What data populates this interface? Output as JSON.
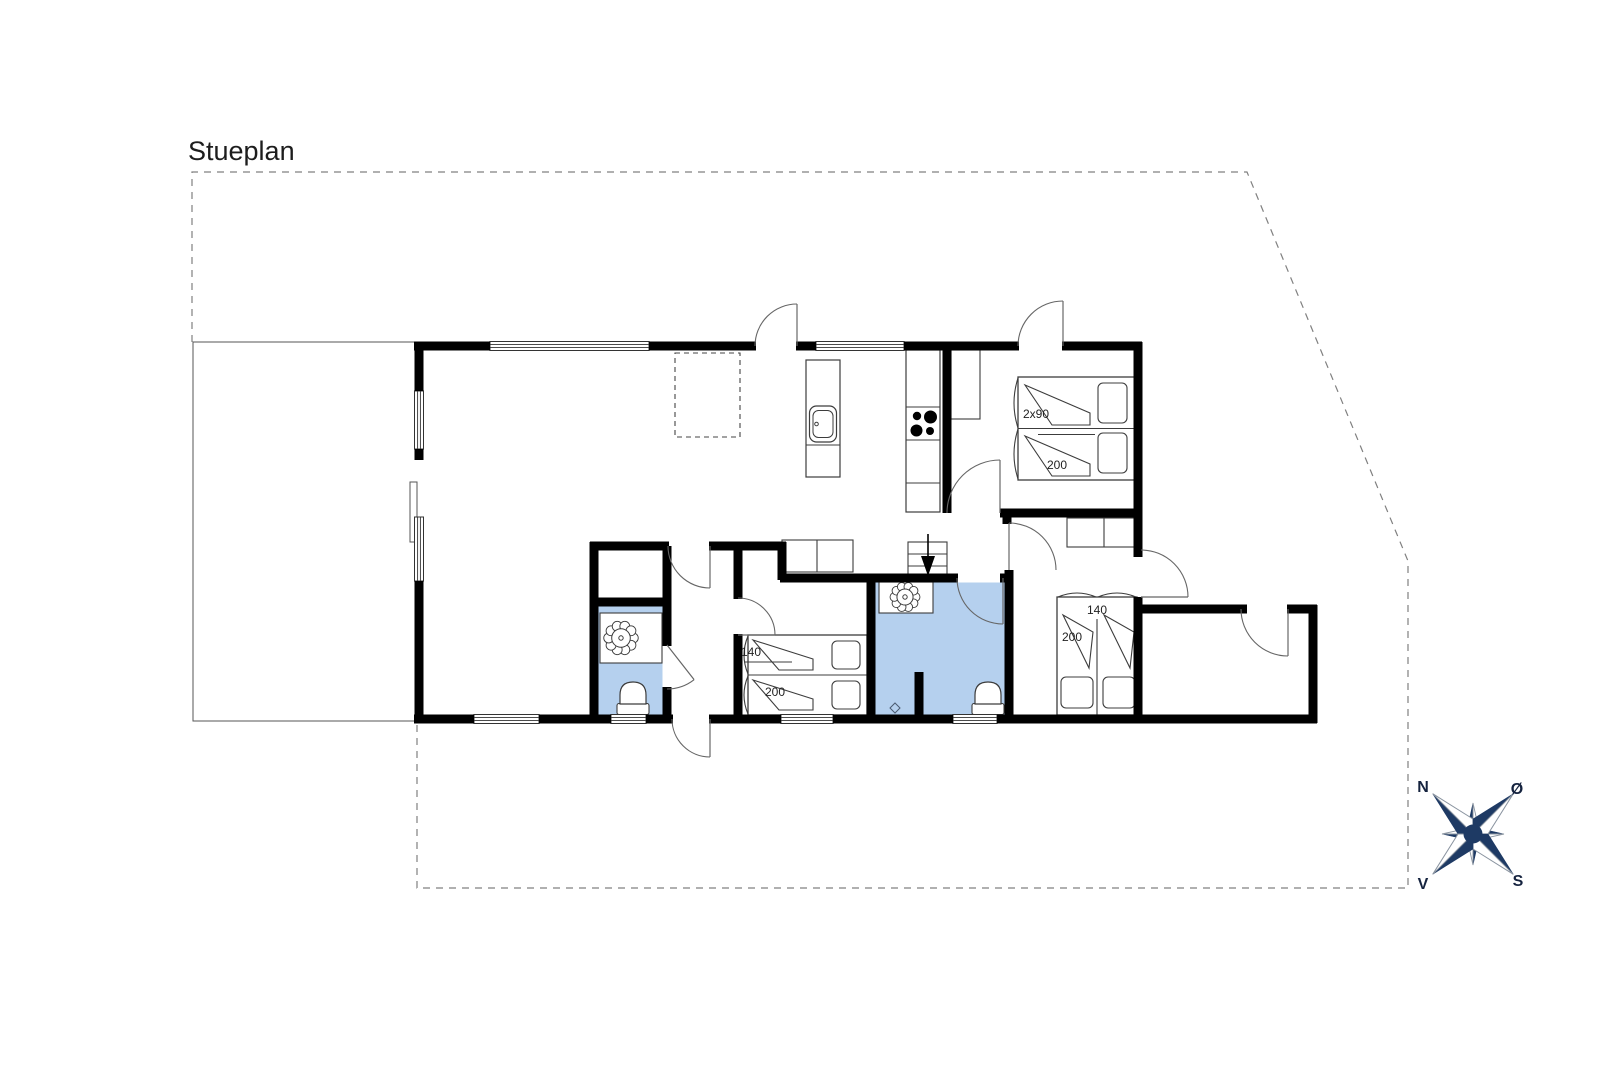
{
  "texts": [
    {
      "id": "plan-title",
      "t": "Stueplan",
      "x": 188,
      "y": 160,
      "s": 27,
      "a": "start",
      "fw": "400",
      "f": "#1d1d1d"
    },
    {
      "id": "bed1-width-label",
      "t": "2x90",
      "x": 1036,
      "y": 418,
      "s": 12,
      "a": "middle",
      "fw": "400",
      "f": "#222222"
    },
    {
      "id": "bed1-length-label",
      "t": "200",
      "x": 1057,
      "y": 469,
      "s": 12,
      "a": "middle",
      "fw": "400",
      "f": "#222222"
    },
    {
      "id": "bed2-width-label",
      "t": "140",
      "x": 751,
      "y": 656,
      "s": 12,
      "a": "middle",
      "fw": "400",
      "f": "#222222"
    },
    {
      "id": "bed2-length-label",
      "t": "200",
      "x": 775,
      "y": 696,
      "s": 12,
      "a": "middle",
      "fw": "400",
      "f": "#222222"
    },
    {
      "id": "bed3-width-label",
      "t": "140",
      "x": 1097,
      "y": 614,
      "s": 12,
      "a": "middle",
      "fw": "400",
      "f": "#222222"
    },
    {
      "id": "bed3-length-label",
      "t": "200",
      "x": 1072,
      "y": 641,
      "s": 12,
      "a": "middle",
      "fw": "400",
      "f": "#222222"
    },
    {
      "id": "compass-label-north",
      "t": "N",
      "x": 1423,
      "y": 792,
      "s": 16,
      "a": "middle",
      "fw": "600",
      "f": "#15233f"
    },
    {
      "id": "compass-label-east",
      "t": "Ø",
      "x": 1517,
      "y": 794,
      "s": 16,
      "a": "middle",
      "fw": "600",
      "f": "#15233f"
    },
    {
      "id": "compass-label-south",
      "t": "S",
      "x": 1518,
      "y": 886,
      "s": 16,
      "a": "middle",
      "fw": "600",
      "f": "#15233f"
    },
    {
      "id": "compass-label-west",
      "t": "V",
      "x": 1423,
      "y": 889,
      "s": 16,
      "a": "middle",
      "fw": "600",
      "f": "#15233f"
    }
  ],
  "colors": {
    "wall": "#000000",
    "thin": "#3c3c3c",
    "door": "#666666",
    "bath": "#b5d0ee",
    "dash": "#808080",
    "navy": "#1e3a64",
    "compass_light_stroke": "#8a94a0"
  },
  "plot": {
    "points": [
      [
        192,
        342
      ],
      [
        192,
        172
      ],
      [
        1247,
        172
      ],
      [
        1408,
        561
      ],
      [
        1408,
        888
      ],
      [
        417,
        888
      ],
      [
        417,
        723
      ]
    ]
  },
  "terrace": {
    "points": [
      [
        415,
        342
      ],
      [
        193,
        342
      ],
      [
        193,
        721
      ],
      [
        415,
        721
      ]
    ]
  },
  "skylight": {
    "x": 675,
    "y": 353,
    "w": 65,
    "h": 84
  },
  "bathrooms": [
    {
      "x": 875.5,
      "y": 582.5,
      "w": 129,
      "h": 132
    },
    {
      "x": 598.5,
      "y": 606.5,
      "w": 64,
      "h": 108
    }
  ],
  "walls": [
    [
      414,
      346,
      490,
      346
    ],
    [
      649,
      346,
      756,
      346
    ],
    [
      796,
      346,
      816,
      346
    ],
    [
      904,
      346,
      1019,
      346
    ],
    [
      1062,
      346,
      1142,
      346
    ],
    [
      419,
      342,
      419,
      391
    ],
    [
      419,
      449,
      419,
      460
    ],
    [
      419,
      581,
      419,
      723
    ],
    [
      414,
      719,
      474,
      719
    ],
    [
      539,
      719,
      611,
      719
    ],
    [
      646,
      719,
      673,
      719
    ],
    [
      709,
      719,
      781,
      719
    ],
    [
      833,
      719,
      953,
      719
    ],
    [
      997,
      719,
      1317,
      719
    ],
    [
      1138,
      342,
      1138,
      557
    ],
    [
      1138,
      597,
      1138,
      723
    ],
    [
      1134,
      609,
      1247,
      609
    ],
    [
      1287,
      609,
      1317,
      609
    ],
    [
      1313,
      605,
      1313,
      723
    ],
    [
      947,
      346,
      947,
      513
    ],
    [
      1000,
      513,
      1140,
      513
    ],
    [
      1007,
      509,
      1007,
      524
    ],
    [
      1009,
      570,
      1009,
      719
    ],
    [
      871,
      578,
      958,
      578
    ],
    [
      1000,
      578,
      1013,
      578
    ],
    [
      871,
      574,
      871,
      719
    ],
    [
      919,
      672,
      919,
      719
    ],
    [
      590,
      546,
      669,
      546
    ],
    [
      709,
      546,
      786,
      546
    ],
    [
      782,
      542,
      782,
      580
    ],
    [
      780,
      578,
      875,
      578
    ],
    [
      594,
      542,
      594,
      719
    ],
    [
      667,
      546,
      667,
      602
    ],
    [
      590,
      602,
      671,
      602
    ],
    [
      667,
      602,
      667,
      646
    ],
    [
      667,
      687,
      667,
      719
    ],
    [
      738,
      542,
      738,
      599
    ],
    [
      738,
      634,
      738,
      719
    ]
  ],
  "windows": [
    {
      "x": 490,
      "y": 346,
      "len": 159,
      "o": "h"
    },
    {
      "x": 816,
      "y": 346,
      "len": 88,
      "o": "h"
    },
    {
      "x": 419,
      "y": 391,
      "len": 58,
      "o": "v"
    },
    {
      "x": 419,
      "y": 517,
      "len": 64,
      "o": "v"
    },
    {
      "x": 474,
      "y": 719,
      "len": 65,
      "o": "h"
    },
    {
      "x": 611,
      "y": 719,
      "len": 35,
      "o": "h"
    },
    {
      "x": 781,
      "y": 719,
      "len": 52,
      "o": "h"
    },
    {
      "x": 953,
      "y": 719,
      "len": 44,
      "o": "h"
    }
  ],
  "terrace_door_panel": {
    "x": 410,
    "y": 482,
    "w": 7,
    "h": 60
  },
  "doors": [
    {
      "hx": 797,
      "hy": 346,
      "r": 42,
      "leaf": 270,
      "end": 180,
      "sweep": 0
    },
    {
      "hx": 1063,
      "hy": 346,
      "r": 45,
      "leaf": 270,
      "end": 180,
      "sweep": 0
    },
    {
      "hx": 710,
      "hy": 719,
      "r": 38,
      "leaf": 90,
      "end": 180,
      "sweep": 1
    },
    {
      "hx": 710,
      "hy": 546,
      "r": 42,
      "leaf": 90,
      "end": 180,
      "sweep": 1
    },
    {
      "hx": 738,
      "hy": 635,
      "r": 37,
      "leaf": 0,
      "end": 270,
      "sweep": 0
    },
    {
      "hx": 667,
      "hy": 645,
      "r": 44,
      "leaf": 52,
      "end": 90,
      "sweep": 1
    },
    {
      "hx": 1000,
      "hy": 513,
      "r": 53,
      "leaf": 270,
      "end": 180,
      "sweep": 0
    },
    {
      "hx": 1009,
      "hy": 570,
      "r": 47,
      "leaf": 270,
      "end": 0,
      "sweep": 1
    },
    {
      "hx": 1141,
      "hy": 597,
      "r": 47,
      "leaf": 0,
      "end": 270,
      "sweep": 0
    },
    {
      "hx": 1288,
      "hy": 609,
      "r": 47,
      "leaf": 90,
      "end": 180,
      "sweep": 1
    },
    {
      "hx": 1003,
      "hy": 578,
      "r": 46,
      "leaf": 90,
      "end": 180,
      "sweep": 1
    }
  ],
  "wardrobes": [
    {
      "x": 951,
      "y": 350,
      "w": 29,
      "h": 69
    },
    {
      "x": 782,
      "y": 540,
      "w": 71,
      "h": 32,
      "div": 817
    },
    {
      "x": 1067,
      "y": 518,
      "w": 73,
      "h": 29,
      "div": 1104
    }
  ],
  "island": {
    "x": 806,
    "y": 360,
    "w": 34,
    "h": 117,
    "div_y": 445,
    "sink": {
      "x": 809.5,
      "y": 406,
      "w": 27,
      "h": 36,
      "ix": 813,
      "iy": 410.5,
      "iw": 20,
      "ih": 27,
      "dx": 816.5,
      "dy": 424
    }
  },
  "counter": {
    "x": 906,
    "y": 350,
    "w": 34,
    "h": 162,
    "divs": [
      407,
      440,
      483
    ],
    "burners": [
      [
        917,
        416,
        4.2
      ],
      [
        930.5,
        417,
        6.5
      ],
      [
        916.5,
        430.5,
        6
      ],
      [
        930,
        431,
        4
      ]
    ]
  },
  "stairs": {
    "x": 908,
    "y": 542,
    "w": 39,
    "h": 36,
    "rows": [
      554,
      566
    ],
    "col": 928,
    "stem": [
      928,
      534,
      928,
      557
    ],
    "tri": [
      [
        921,
        556
      ],
      [
        935,
        556
      ],
      [
        928,
        576
      ]
    ]
  },
  "beds": [
    {
      "x": 1018,
      "y": 377,
      "w": 120,
      "h": 103,
      "div": [
        "h",
        428.5
      ],
      "pillows": [
        [
          1098,
          383,
          29,
          40
        ],
        [
          1098,
          433,
          29,
          40
        ]
      ],
      "duvets": [
        "M1025,385 L1090,413 L1090,425 L1052,425 Z",
        "M1025,436 L1090,464 L1090,476 L1052,476 Z"
      ],
      "bumps": [
        [
          "v",
          1018,
          378,
          428
        ],
        [
          "v",
          1018,
          429,
          479
        ]
      ],
      "extra": [
        1038,
        434.5,
        1095,
        434.5
      ]
    },
    {
      "x": 748,
      "y": 635,
      "w": 119,
      "h": 80,
      "div": [
        "h",
        675
      ],
      "pillows": [
        [
          832,
          641,
          28,
          28
        ],
        [
          832,
          681,
          28,
          28
        ]
      ],
      "duvets": [
        "M753,640 L813,659 L813,670 L779,670 Z",
        "M753,680 L813,699 L813,710 L779,710 Z"
      ],
      "bumps": [
        [
          "v",
          748,
          636,
          674
        ],
        [
          "v",
          748,
          676,
          714
        ]
      ],
      "extra": [
        744,
        662,
        792,
        662
      ]
    },
    {
      "x": 1057,
      "y": 597,
      "w": 80,
      "h": 118,
      "div": [
        "v",
        1097,
        619
      ],
      "pillows": [
        [
          1061,
          677,
          32,
          31
        ],
        [
          1103,
          677,
          32,
          31
        ]
      ],
      "duvets": [
        "M1063,615 L1089,668 L1093,632 Z",
        "M1104,615 L1130,668 L1134,632 Z"
      ],
      "bumps": [
        [
          "h",
          1058,
          1096,
          597
        ],
        [
          "h",
          1098,
          1136,
          597
        ]
      ]
    }
  ],
  "sinks": [
    {
      "sq": [
        600,
        613,
        62,
        50
      ],
      "c": [
        621,
        638
      ],
      "r": 15
    },
    {
      "sq": [
        879,
        582,
        54,
        31
      ],
      "c": [
        905,
        597
      ],
      "r": 13
    }
  ],
  "toilets": [
    {
      "cx": 633
    },
    {
      "cx": 988
    }
  ],
  "drain": {
    "x": 895,
    "y": 708,
    "s": 5
  },
  "compass": {
    "cx": 1473,
    "cy": 834,
    "R": 57,
    "w": 15,
    "R2": 31,
    "w2": 8
  }
}
